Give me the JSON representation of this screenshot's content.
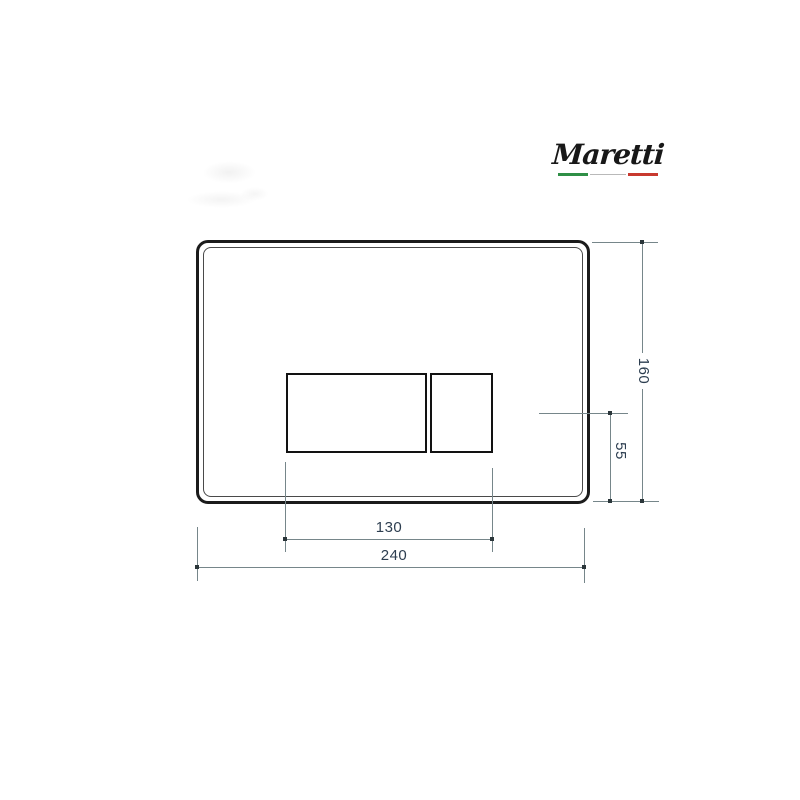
{
  "brand": {
    "name": "Maretti",
    "flag": {
      "green": "#2f8f46",
      "gray": "#b9b9b9",
      "red": "#c8392f"
    }
  },
  "drawing": {
    "object": "flush-plate-dimension-drawing",
    "dimensions": {
      "plate_width": "240",
      "plate_height": "160",
      "buttons_width": "130",
      "button_center_to_bottom": "55"
    },
    "colors": {
      "outline": "#1b1b1b",
      "dimension_line": "#76868a",
      "dimension_text": "#2d3e50"
    }
  }
}
